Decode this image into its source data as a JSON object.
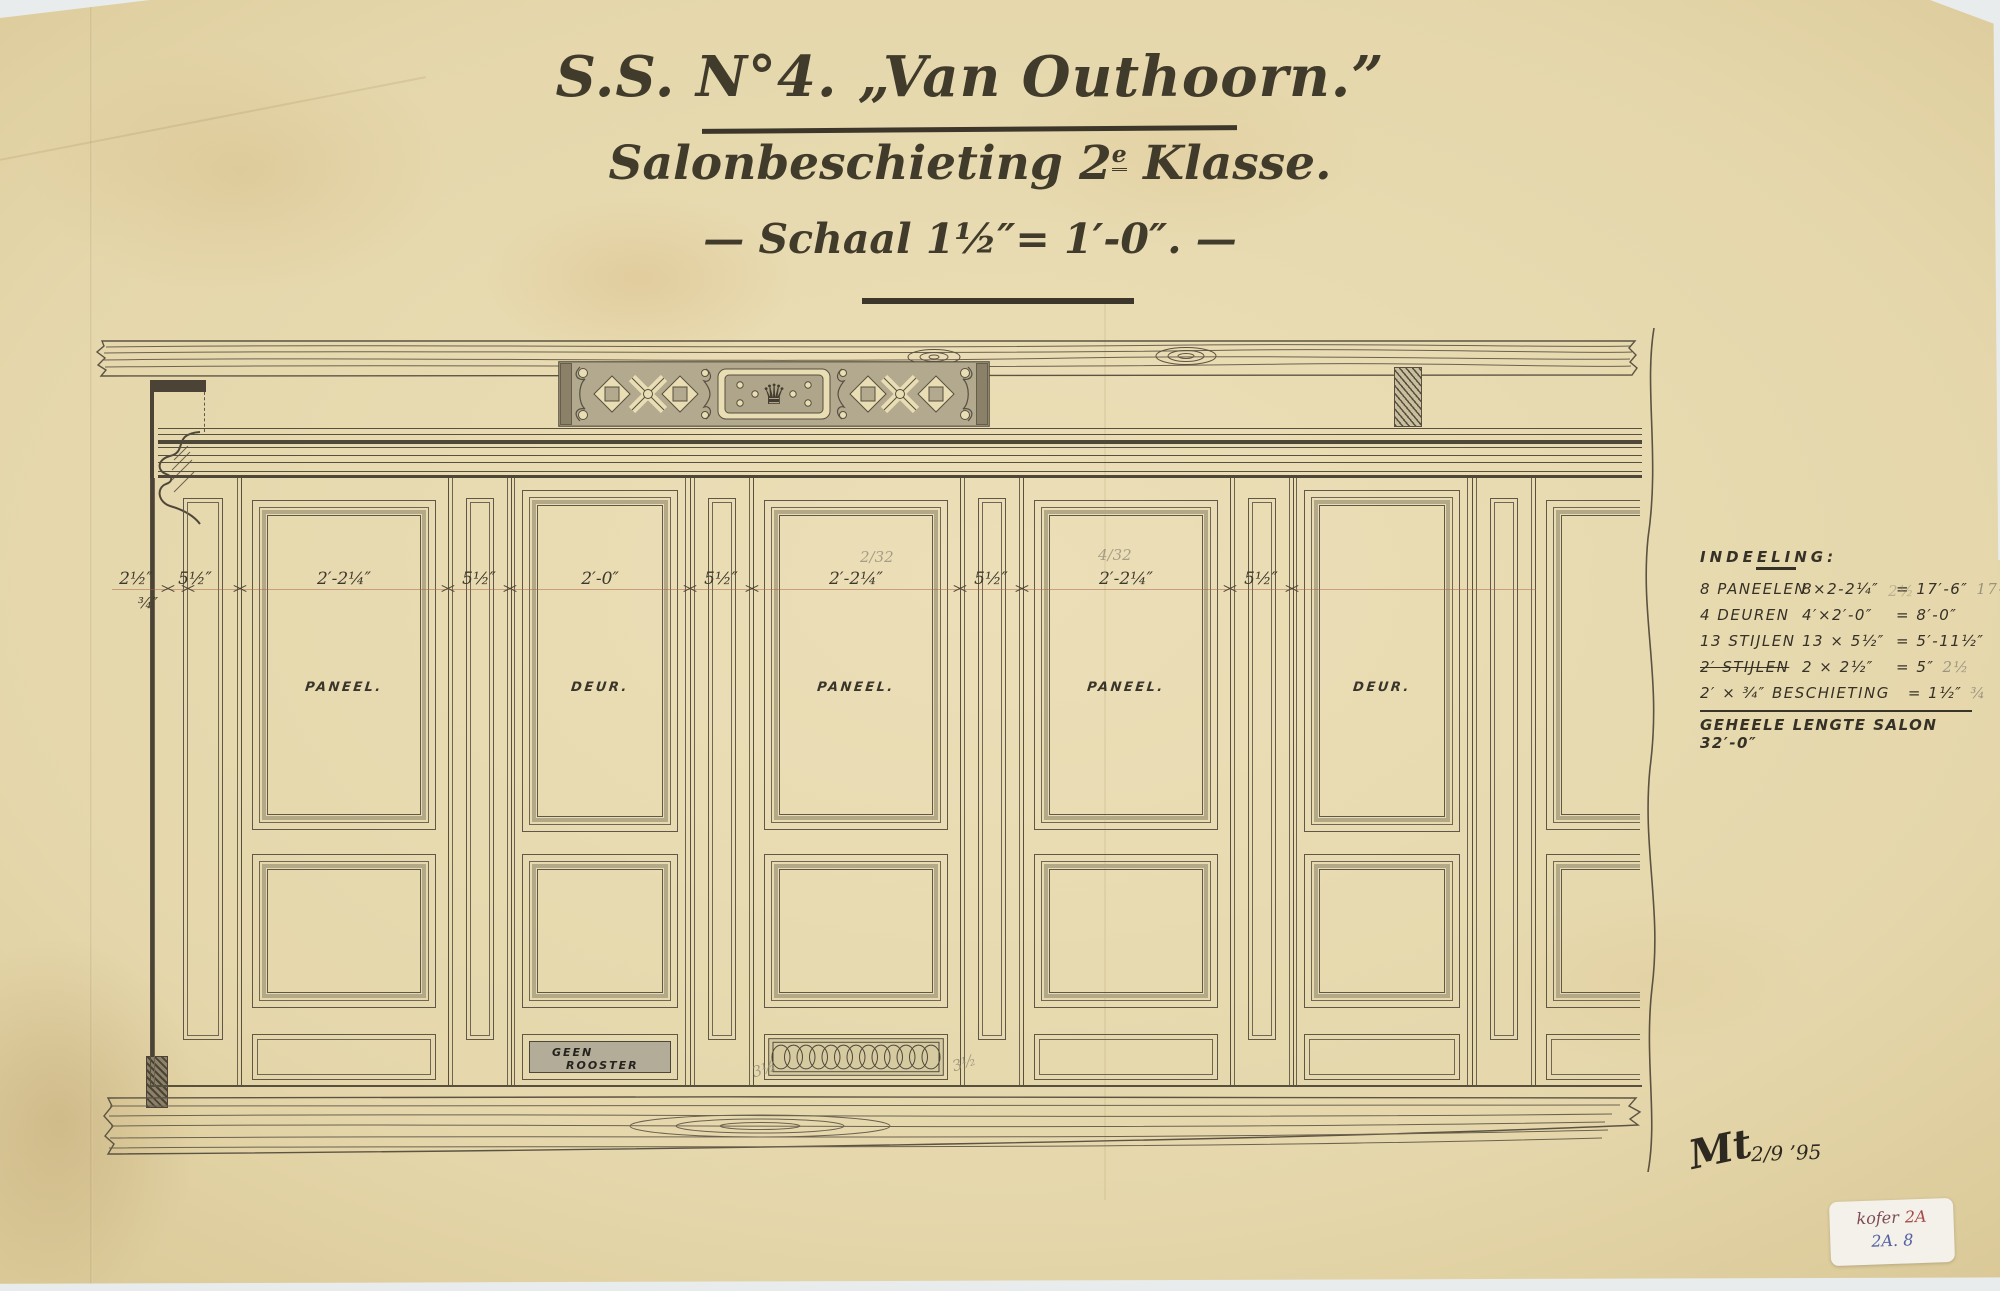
{
  "title": {
    "line1": "S.S. N°4. „Van Outhoorn.”",
    "line2a": "Salonbeschieting 2",
    "line2sup": "e",
    "line2b": " Klasse.",
    "line3": "— Schaal 1½″= 1′-0″. —"
  },
  "drawing": {
    "bays": [
      {
        "label": "PANEEL.",
        "dim": "2′-2¼″"
      },
      {
        "label": "DEUR.",
        "dim": "2′-0″"
      },
      {
        "label": "PANEEL.",
        "dim": "2′-2¼″"
      },
      {
        "label": "PANEEL.",
        "dim": "2′-2¼″"
      },
      {
        "label": "DEUR.",
        "dim": ""
      }
    ],
    "dims": {
      "stile": "5½″",
      "edge_top": "2½″",
      "edge_bottom": "¾″"
    },
    "plinth_note": {
      "line1": "GEEN",
      "line2": "ROOSTER"
    },
    "pencil": {
      "note1": "2/32",
      "note2": "4/32",
      "note3": "3½",
      "note4": "3½"
    }
  },
  "legend": {
    "heading": "INDEELING:",
    "rows": [
      {
        "item": "8 PANEELEN",
        "calc": "8×2-2¼″",
        "res": "= 17′-6″",
        "pencil": "17-3¼"
      },
      {
        "item": "4 DEUREN",
        "calc": "4′×2′-0″",
        "res": "= 8′-0″",
        "pencil": ""
      },
      {
        "item": "13 STIJLEN",
        "calc": "13 × 5½″",
        "res": "= 5′-11½″",
        "pencil": ""
      },
      {
        "item": "2′ STIJLEN",
        "calc": "2 × 2½″",
        "res": "= 5″",
        "pencil": "2½"
      },
      {
        "item": "2′ × ¾″ BESCHIETING",
        "calc": "",
        "res": "= 1½″",
        "pencil": "¾"
      }
    ],
    "ghost_top": "2½",
    "total": "GEHEELE LENGTE SALON 32′-0″"
  },
  "icons": {
    "crown": "♛"
  },
  "signature": {
    "monogram": "Mt",
    "date": "2/9 ’95"
  },
  "sticker": {
    "line1a": "kofer",
    "line1b": "2A",
    "line2": "2A. 8"
  },
  "colors": {
    "paper": "#e5d7ab",
    "ink": "#57503f",
    "dimline": "#ac6046",
    "frieze_bg": "#b2a98f"
  }
}
